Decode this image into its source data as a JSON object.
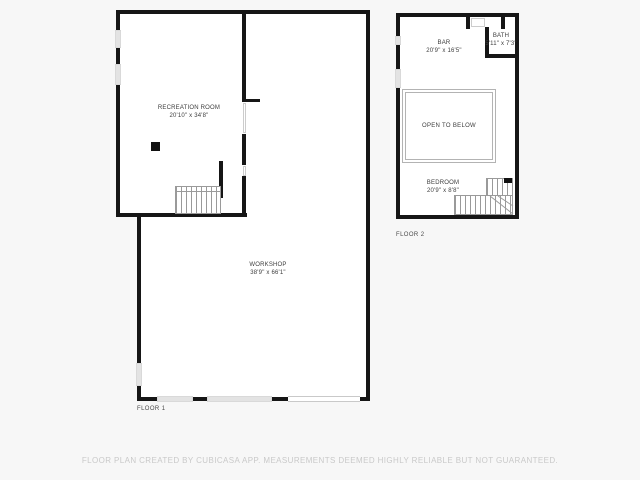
{
  "colors": {
    "background": "#f7f7f7",
    "wall": "#161616",
    "window_marker": "#e3e3e3",
    "stair_line": "#9a9a9a",
    "label_text": "#3d3d3d",
    "disclaimer_text": "#c9c9c9"
  },
  "floor1": {
    "label": "FLOOR 1",
    "recreation_room": {
      "name": "RECREATION ROOM",
      "dims": "20'10\" x 34'8\""
    },
    "workshop": {
      "name": "WORKSHOP",
      "dims": "38'9\" x 66'1\""
    }
  },
  "floor2": {
    "label": "FLOOR 2",
    "bar": {
      "name": "BAR",
      "dims": "20'9\" x 16'5\""
    },
    "bath": {
      "name": "BATH",
      "dims": "5'11\" x 7'3\""
    },
    "open_to_below": {
      "name": "OPEN TO BELOW"
    },
    "bedroom": {
      "name": "BEDROOM",
      "dims": "20'9\" x 8'8\""
    }
  },
  "footer": {
    "disclaimer": "FLOOR PLAN CREATED BY CUBICASA APP. MEASUREMENTS DEEMED HIGHLY RELIABLE BUT NOT GUARANTEED."
  }
}
